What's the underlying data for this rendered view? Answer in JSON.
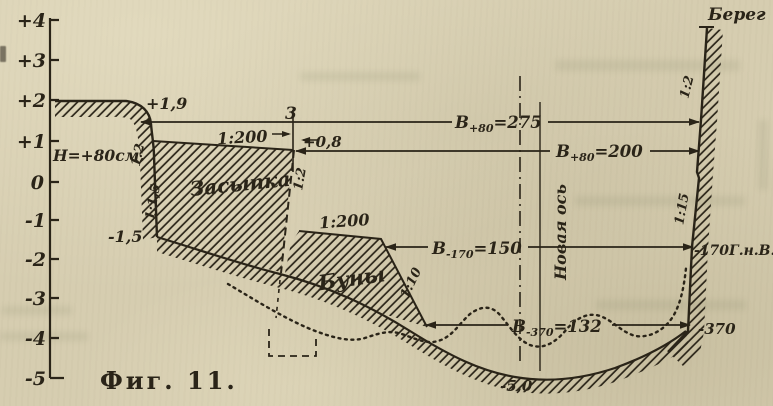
{
  "figure": {
    "caption": "Фиг. 11.",
    "paper_color": "#d6cdb0",
    "ink_color": "#2a2418"
  },
  "axis": {
    "labels": [
      "+4",
      "+3",
      "+2",
      "+1",
      "0",
      "-1",
      "-2",
      "-3",
      "-4",
      "-5"
    ]
  },
  "labels": {
    "bereg": "Берег",
    "zasypka": "Засыпка",
    "buny": "Буны",
    "novaya_os": "Новая ось",
    "h_level": "Н=+80см.",
    "elev_plus19": "+1,9",
    "elev_minus15": "-1,5",
    "dim_three": "3",
    "dim_plus08": "+0,8",
    "depth_minus50": "-5,0",
    "gnv": "-170Г.н.В.",
    "elev_minus370": "-370"
  },
  "slopes": {
    "left_upper": "1:2",
    "left_lower": "1:1,5",
    "fill_edge": "1:2",
    "berm_upper": "1:200",
    "berm_lower": "1:200",
    "groyne": "1:10",
    "right_upper": "1:2",
    "right_lower": "1:15"
  },
  "dims": [
    {
      "base": "В",
      "sub": "+80",
      "value": "=275"
    },
    {
      "base": "В",
      "sub": "+80",
      "value": "=200"
    },
    {
      "base": "В",
      "sub": "-170",
      "value": "=150"
    },
    {
      "base": "В",
      "sub": "-370",
      "value": "=132"
    }
  ]
}
